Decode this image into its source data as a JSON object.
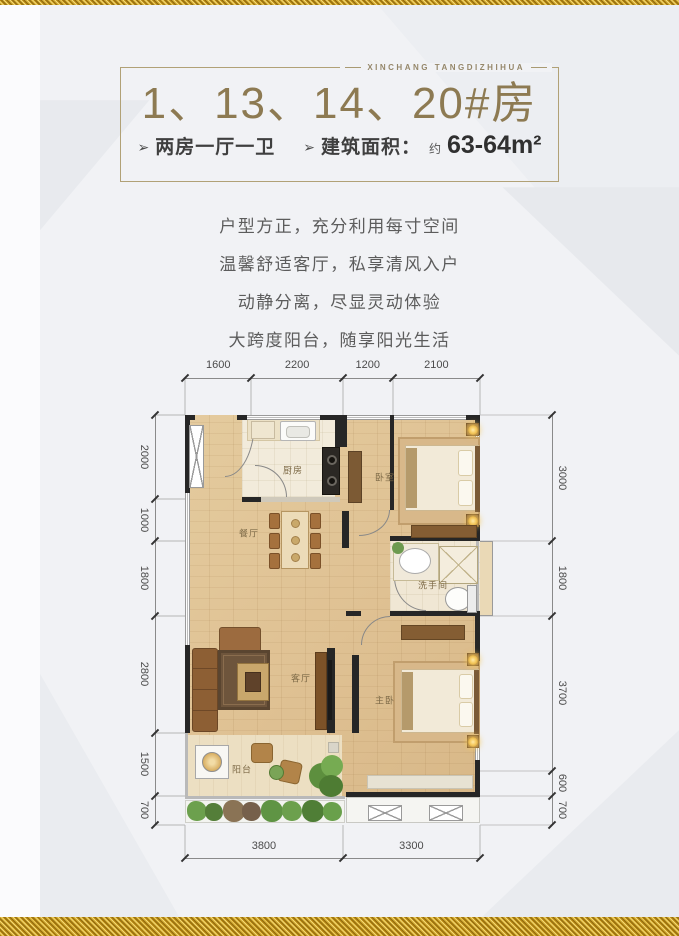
{
  "brand": {
    "name": "XINCHANG TANGDIZHIHUA"
  },
  "header": {
    "title": "1、13、14、20#房",
    "arrow": "➢",
    "layout_tag": "两房一厅一卫",
    "area_label": "建筑面积：",
    "area_approx": "约",
    "area_value": "63-64m²"
  },
  "description": {
    "lines": [
      "户型方正，充分利用每寸空间",
      "温馨舒适客厅，私享清风入户",
      "动静分离，尽显灵动体验",
      "大跨度阳台，随享阳光生活"
    ]
  },
  "floorplan": {
    "rooms": {
      "kitchen": "厨房",
      "bedroom": "卧室",
      "dining": "餐厅",
      "living": "客厅",
      "bathroom": "洗手间",
      "master_bedroom": "主卧",
      "balcony": "阳台"
    },
    "dimensions_mm": {
      "top": [
        1600,
        2200,
        1200,
        2100
      ],
      "bottom": [
        3800,
        3300
      ],
      "left": [
        2000,
        1000,
        1800,
        2800,
        1500,
        700
      ],
      "right": [
        3000,
        1800,
        3700,
        600,
        700
      ]
    }
  },
  "colors": {
    "accent_gold": "#8d7a52",
    "glitter_gold": "#c49a2a",
    "wall": "#262626",
    "floor_wood": "#dfc193",
    "dim_text": "#4b4b4b"
  }
}
